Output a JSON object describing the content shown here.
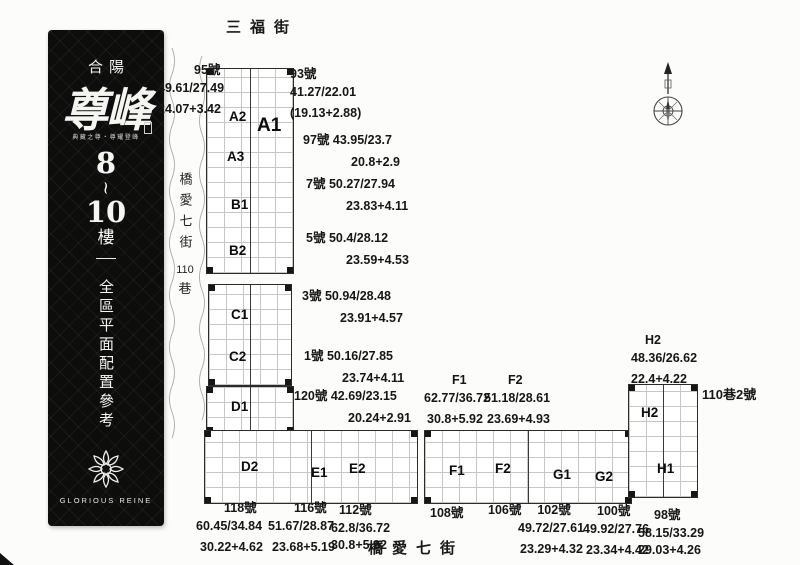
{
  "banner": {
    "brand": "合陽",
    "title": "尊峰",
    "tagline": "典藏之尊・尊耀登峰",
    "floors_top": "8",
    "floors_tilde": "~",
    "floors_mid": "10",
    "floors_suffix": "樓",
    "subtitle": "全區平面配置參考圖",
    "logo_text": "GLORIOUS REINE"
  },
  "streets": {
    "top": "三福街",
    "bottom": "橋愛七街",
    "left_vertical_cjk": "橋愛七街",
    "left_vertical_num": "110",
    "left_vertical_suffix": "巷",
    "right_label": "110巷2號"
  },
  "units": {
    "a1": "A1",
    "a2": "A2",
    "a3": "A3",
    "b1": "B1",
    "b2": "B2",
    "c1": "C1",
    "c2": "C2",
    "d1": "D1",
    "d2": "D2",
    "e1": "E1",
    "e2": "E2",
    "f1": "F1",
    "f2": "F2",
    "g1": "G1",
    "g2": "G2",
    "h1": "H1",
    "h2": "H2"
  },
  "labels": {
    "no95": {
      "title": "95號",
      "l1": "49.61/27.49",
      "l2": "24.07+3.42"
    },
    "no93": {
      "title": "93號",
      "l1": "41.27/22.01",
      "l2": "(19.13+2.88)"
    },
    "no97": {
      "title": "97號",
      "l1": "43.95/23.7",
      "l2": "20.8+2.9"
    },
    "no7": {
      "title": "7號",
      "l1": "50.27/27.94",
      "l2": "23.83+4.11"
    },
    "no5": {
      "title": "5號",
      "l1": "50.4/28.12",
      "l2": "23.59+4.53"
    },
    "no3": {
      "title": "3號",
      "l1": "50.94/28.48",
      "l2": "23.91+4.57"
    },
    "no1": {
      "title": "1號",
      "l1": "50.16/27.85",
      "l2": "23.74+4.11"
    },
    "no120": {
      "title": "120號",
      "l1": "42.69/23.15",
      "l2": "20.24+2.91"
    },
    "f1": {
      "title": "F1",
      "l1": "62.77/36.72",
      "l2": "30.8+5.92"
    },
    "f2": {
      "title": "F2",
      "l1": "51.18/28.61",
      "l2": "23.69+4.93"
    },
    "h2": {
      "title": "H2",
      "l1": "48.36/26.62",
      "l2": "22.4+4.22"
    },
    "no118": {
      "title": "118號",
      "l1": "60.45/34.84",
      "l2": "30.22+4.62"
    },
    "no116": {
      "title": "116號",
      "l1": "51.67/28.87",
      "l2": "23.68+5.19"
    },
    "no112": {
      "title": "112號",
      "l1": "62.8/36.72",
      "l2": "30.8+5.92"
    },
    "no108": {
      "title": "108號"
    },
    "no106": {
      "title": "106號"
    },
    "no102": {
      "title": "102號",
      "l1": "49.72/27.61",
      "l2": "23.29+4.32"
    },
    "no100": {
      "title": "100號",
      "l1": "49.92/27.76",
      "l2": "23.34+4.42"
    },
    "no98": {
      "title": "98號",
      "l1": "58.15/33.29",
      "l2": "29.03+4.26"
    }
  }
}
